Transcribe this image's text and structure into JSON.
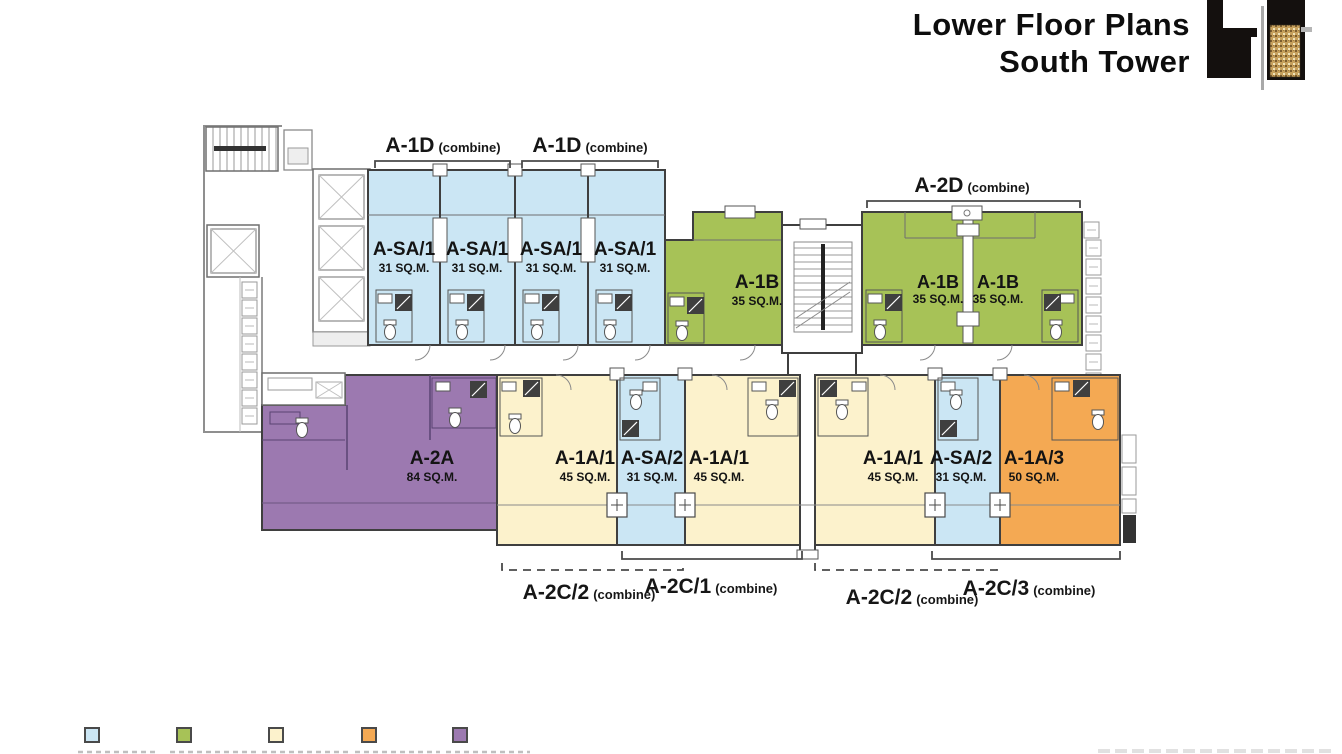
{
  "title": {
    "line1": "Lower Floor Plans",
    "line2": "South Tower"
  },
  "colors": {
    "studio_blue": "#cbe6f4",
    "green": "#a7c257",
    "cream": "#fcf2cc",
    "orange": "#f4a953",
    "purple": "#9c79b0",
    "wall": "#3f3f3f"
  },
  "combines": {
    "top": [
      {
        "label": "A-1D",
        "suffix": "(combine)"
      },
      {
        "label": "A-1D",
        "suffix": "(combine)"
      },
      {
        "label": "A-2D",
        "suffix": "(combine)"
      }
    ],
    "bottom": [
      {
        "label": "A-2C/2",
        "suffix": "(combine)"
      },
      {
        "label": "A-2C/1",
        "suffix": "(combine)"
      },
      {
        "label": "A-2C/2",
        "suffix": "(combine)"
      },
      {
        "label": "A-2C/3",
        "suffix": "(combine)"
      }
    ]
  },
  "units": [
    {
      "name": "A-SA/1",
      "area": "31 SQ.M."
    },
    {
      "name": "A-SA/1",
      "area": "31 SQ.M."
    },
    {
      "name": "A-SA/1",
      "area": "31 SQ.M."
    },
    {
      "name": "A-SA/1",
      "area": "31 SQ.M."
    },
    {
      "name": "A-1B",
      "area": "35 SQ.M."
    },
    {
      "name": "A-1B",
      "area": "35 SQ.M."
    },
    {
      "name": "A-1B",
      "area": "35 SQ.M."
    },
    {
      "name": "A-2A",
      "area": "84 SQ.M."
    },
    {
      "name": "A-1A/1",
      "area": "45 SQ.M."
    },
    {
      "name": "A-SA/2",
      "area": "31 SQ.M."
    },
    {
      "name": "A-1A/1",
      "area": "45 SQ.M."
    },
    {
      "name": "A-1A/1",
      "area": "45 SQ.M."
    },
    {
      "name": "A-SA/2",
      "area": "31 SQ.M."
    },
    {
      "name": "A-1A/3",
      "area": "50 SQ.M."
    }
  ],
  "legend": {
    "swatches": [
      "#cbe6f4",
      "#a7c257",
      "#fcf2cc",
      "#f4a953",
      "#9c79b0"
    ]
  }
}
